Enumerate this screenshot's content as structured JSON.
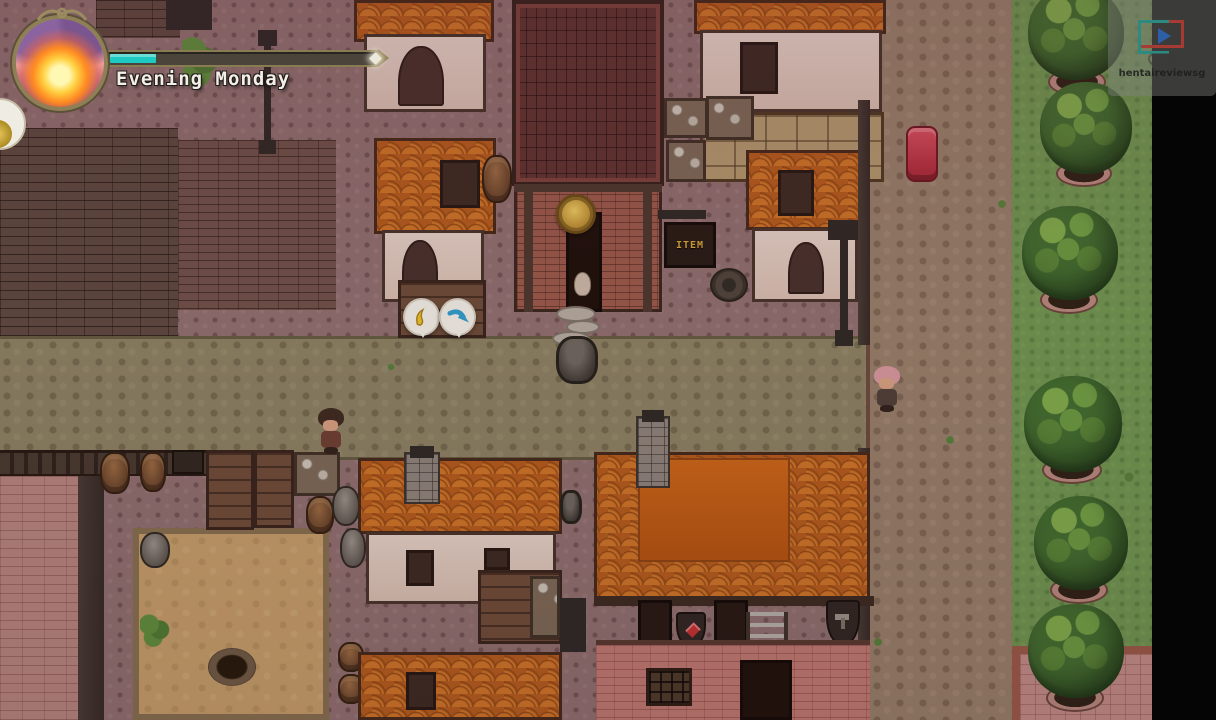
{
  "hud": {
    "label": "Evening Monday",
    "time_of_day": "Evening",
    "day": "Monday",
    "time_bar": {
      "progress_percent": 17,
      "fill_color": "#1ec9c2",
      "track_color": "#4a443b"
    },
    "clock_icon": "sunset-clock-icon"
  },
  "watermark": {
    "text": "hentaireviewsg",
    "play_icon": "play-button-icon",
    "gamepad_icon": "gamepad-icon"
  },
  "scene": {
    "signs": {
      "item_shop": "ITEM"
    },
    "npcs": [
      "villager-brown-hair",
      "villager-pink-hair",
      "doorway-villager",
      "red-handcart"
    ],
    "interaction_bubbles": [
      "harvest-tool-bubble",
      "move-arrow-bubble"
    ],
    "colors": {
      "roof_orange": "#cf7526",
      "roof_dark_tile": "#5e332f",
      "wall_plaster": "#e6d5c9",
      "wall_pink_brick": "#c07a72",
      "cobblestone": "#8f7070",
      "road_olive": "#8b8263",
      "grass": "#6e9750",
      "tree_canopy": "#3f6e2e",
      "sand_yard": "#c6a06a"
    }
  }
}
